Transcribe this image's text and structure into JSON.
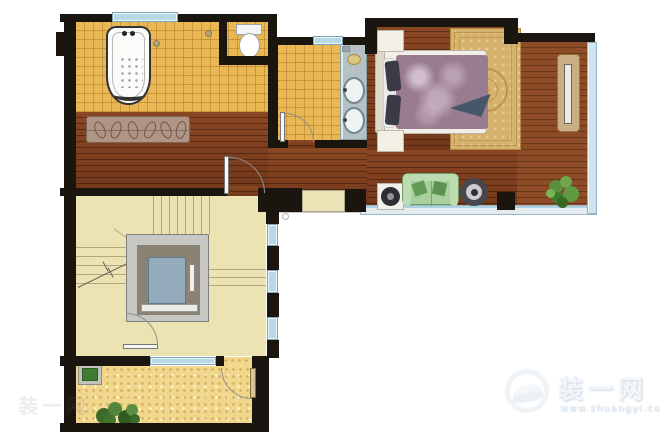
{
  "watermark": {
    "site_name": "装一网",
    "site_url": "www.zhuangyi.com"
  },
  "corner_watermark": {
    "text": "装一网"
  },
  "palette": {
    "wall": "#1b1510",
    "bathroom_tile": "#e9b855",
    "wood_floor": "#7d3d1d",
    "balcony_wood": "#8d4c26",
    "stairwell_floor": "#ebe3b2",
    "terrace_floor": "#f1d78c",
    "window_glass": "#b7d9e6",
    "sofa": "#a9cf9f",
    "bed_cover": "#9a7c91",
    "rug": "#d6b26c",
    "elevator_car": "#93abba",
    "plants": "#4e7d3a",
    "watermark": "#e8f0f7"
  }
}
